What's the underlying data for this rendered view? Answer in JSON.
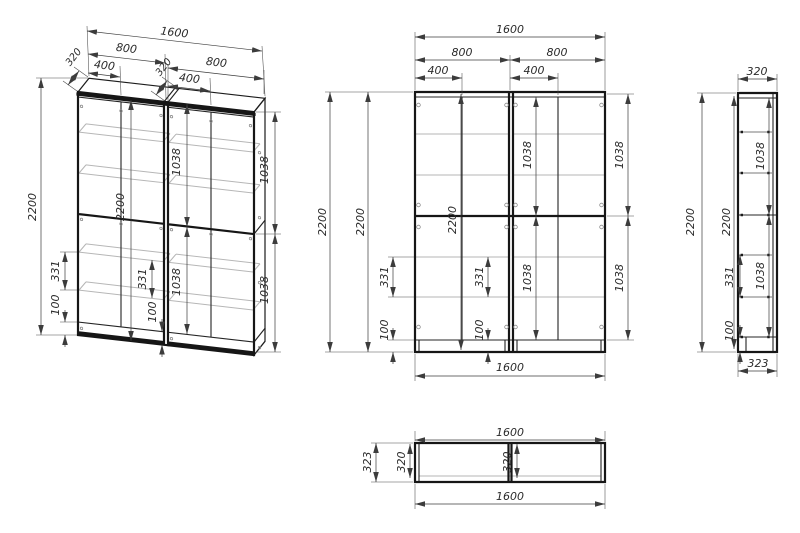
{
  "colors": {
    "line": "#161616",
    "shelf_line": "#b6b6b6",
    "dimension_line": "#3c3c3c",
    "background": "#ffffff"
  },
  "views": {
    "iso": {
      "dims": {
        "total_width": "1600",
        "unit_width_left": "800",
        "unit_width_right": "800",
        "half_width_left": "400",
        "half_width_right": "400",
        "depth_left": "320",
        "depth_right": "320",
        "height_outer": "2200",
        "shelf_gap_outer": "331",
        "plinth_outer": "100",
        "height_inner": "2200",
        "shelf_gap_inner": "331",
        "plinth_inner": "100",
        "upper_section_inner": "1038",
        "lower_section_inner": "1038",
        "upper_section_right": "1038",
        "lower_section_right": "1038"
      }
    },
    "front": {
      "dims": {
        "total_width_top": "1600",
        "unit_width_left": "800",
        "unit_width_right": "800",
        "half_width_left": "400",
        "half_width_right": "400",
        "height_outer_a": "2200",
        "height_outer_b": "2200",
        "height_inner": "2200",
        "shelf_gap_left": "331",
        "shelf_gap_inner": "331",
        "plinth_left": "100",
        "plinth_inner": "100",
        "upper_section_inner": "1038",
        "lower_section_inner": "1038",
        "upper_section_right": "1038",
        "lower_section_right": "1038",
        "total_width_bottom": "1600"
      }
    },
    "side": {
      "dims": {
        "depth_top": "320",
        "height_outer": "2200",
        "height_inner": "2200",
        "shelf_gap": "331",
        "plinth": "100",
        "upper_section": "1038",
        "lower_section": "1038",
        "depth_bottom": "323"
      }
    },
    "plan": {
      "dims": {
        "width_top": "1600",
        "depth_outer": "323",
        "depth_inner_left": "320",
        "depth_inner_middle": "320",
        "width_bottom": "1600"
      }
    }
  }
}
